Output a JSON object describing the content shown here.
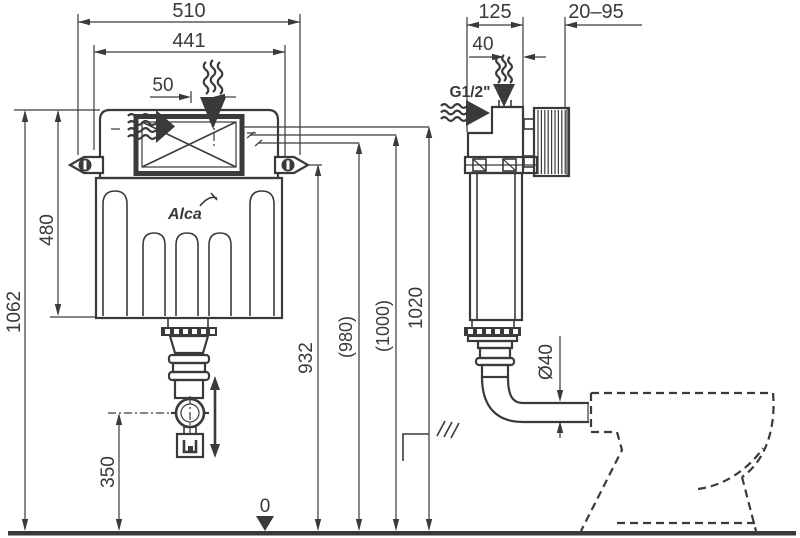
{
  "colors": {
    "line": "#3a3a3a",
    "background": "#ffffff"
  },
  "front": {
    "width_overall": "510",
    "width_inner": "441",
    "inlet_offset": "50",
    "cistern_height": "480",
    "overall_height": "1062",
    "outlet_height": "350",
    "bracket_height": "932",
    "ref_height_a": "(980)",
    "ref_height_b": "(1000)",
    "floor_level": "0",
    "logo": "Alca"
  },
  "side": {
    "depth": "125",
    "wall_thickness_range": "20–95",
    "inlet_offset": "40",
    "inlet_thread": "G1/2\"",
    "ref_height": "1020",
    "outlet_diameter": "Ø40"
  }
}
